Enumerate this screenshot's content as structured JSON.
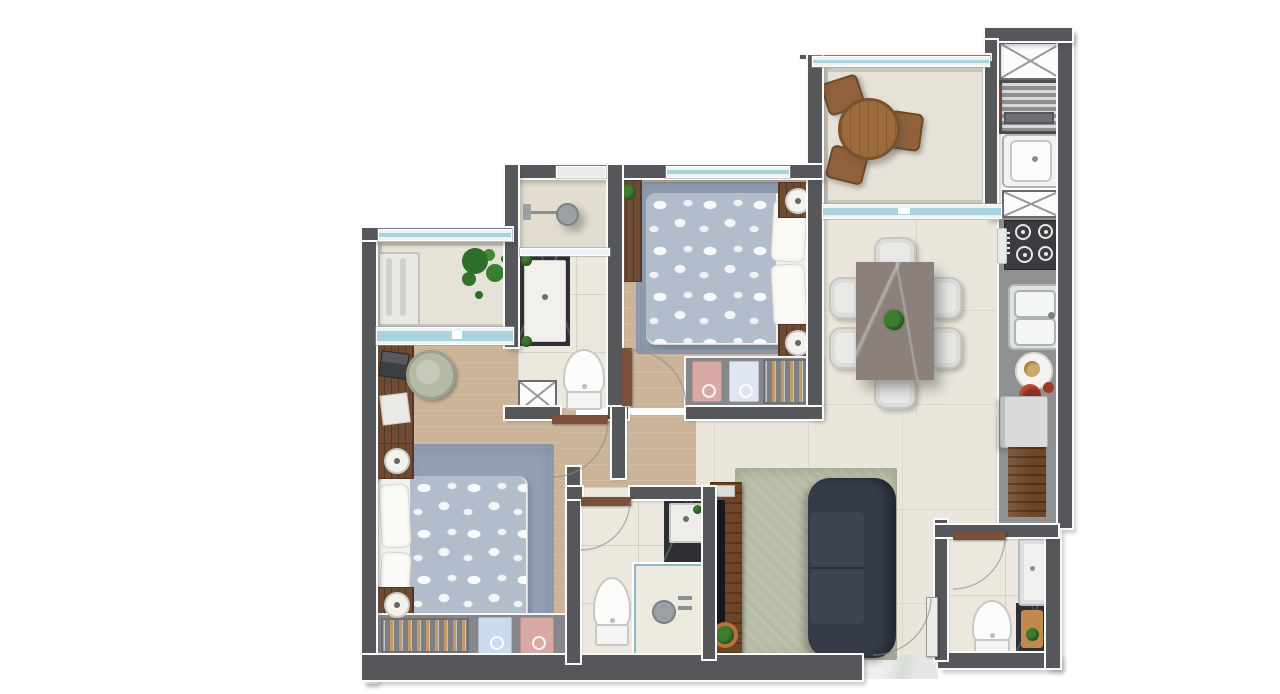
{
  "scene": {
    "description": "Top-down 3D architectural floor plan render of a 2-bedroom apartment, unlabeled (no visible text in image)",
    "visible_text": []
  },
  "palette": {
    "wall": "#56575b",
    "tile": "#eae6dc",
    "tile-line": "#dcd7ca",
    "bath-tile": "#ece8dd",
    "balcony-tile": "#e6e2d7",
    "kitchen-band": "#8f9193",
    "wood": "#cbb498",
    "rug-blue": "#93a0b4",
    "rug-green": "#b8bba5",
    "duvet": "#b2bcca",
    "bed-white": "#f2f1ed",
    "furn-wood": "#6f4b33",
    "furn-wood-dark": "#543823",
    "wardrobe": "#85878a",
    "hanger": "#c29a66",
    "shirt-blue": "#ccdaee",
    "shirt-pink": "#d8a8a4",
    "sofa": "#353c48",
    "sofa-seat": "#3d4552",
    "table-marble": "#8b817a",
    "chair": "#e9e9e7",
    "chair-line": "#c6c6c3",
    "glass": "#a9d3dd",
    "glass-frame": "#ffffff",
    "marble-dark": "#2e2f33",
    "porcelain": "#fbfbf9",
    "porcelain-line": "#c6c9c9",
    "steel": "#c9ccce",
    "stove": "#3a3c40",
    "plant": "#3e7c2f",
    "plant-dark": "#2f6d2a",
    "pot-red": "#8e2f23",
    "fridge": "#d9dadb",
    "threshold": "#e4e7e4",
    "door-wood": "#7a5138"
  },
  "rooms": [
    {
      "id": "left-balcony",
      "furniture": [
        "ac-bench-unit",
        "plant",
        "sliding-window"
      ]
    },
    {
      "id": "master-bedroom",
      "furniture": [
        "desk",
        "desk-chair",
        "laptop",
        "papers",
        "double-bed",
        "nightstand",
        "nightstand",
        "table-lamp",
        "table-lamp",
        "rug",
        "wardrobe-hangers",
        "folded-shirt-blue",
        "folded-shirt-pink"
      ]
    },
    {
      "id": "ensuite-bathroom",
      "furniture": [
        "shower",
        "glass-partition",
        "vanity-counter",
        "toilet",
        "duct-shaft",
        "plants"
      ]
    },
    {
      "id": "bedroom-2",
      "furniture": [
        "shelf",
        "plant",
        "double-bed",
        "nightstand",
        "nightstand",
        "table-lamp",
        "table-lamp",
        "rug",
        "wardrobe-hangers",
        "folded-shirt-pink",
        "folded-shirt-white"
      ]
    },
    {
      "id": "gourmet-balcony",
      "furniture": [
        "round-table",
        "chair",
        "chair",
        "chair",
        "guardrail-glass",
        "sliding-door"
      ]
    },
    {
      "id": "utility-column",
      "furniture": [
        "duct-shaft-x",
        "grill",
        "laundry-tank",
        "duct-shaft-x"
      ]
    },
    {
      "id": "kitchen",
      "furniture": [
        "cooktop-4-burners",
        "double-sink",
        "plate",
        "pot",
        "refrigerator",
        "wood-counter"
      ]
    },
    {
      "id": "living-dining",
      "furniture": [
        "dining-table",
        "dining-chair-x6",
        "centerpiece-plant",
        "sofa",
        "rug",
        "tv-console",
        "tv",
        "soundbar",
        "plant-pot",
        "entry-door",
        "entry-threshold"
      ]
    },
    {
      "id": "bathroom-2",
      "furniture": [
        "toilet",
        "vanity-sink",
        "shower-box",
        "shower-fixture",
        "plants",
        "door"
      ]
    },
    {
      "id": "service-bathroom",
      "furniture": [
        "toilet",
        "shower-tray",
        "marble-counter",
        "wood-board",
        "plant",
        "door"
      ]
    }
  ]
}
